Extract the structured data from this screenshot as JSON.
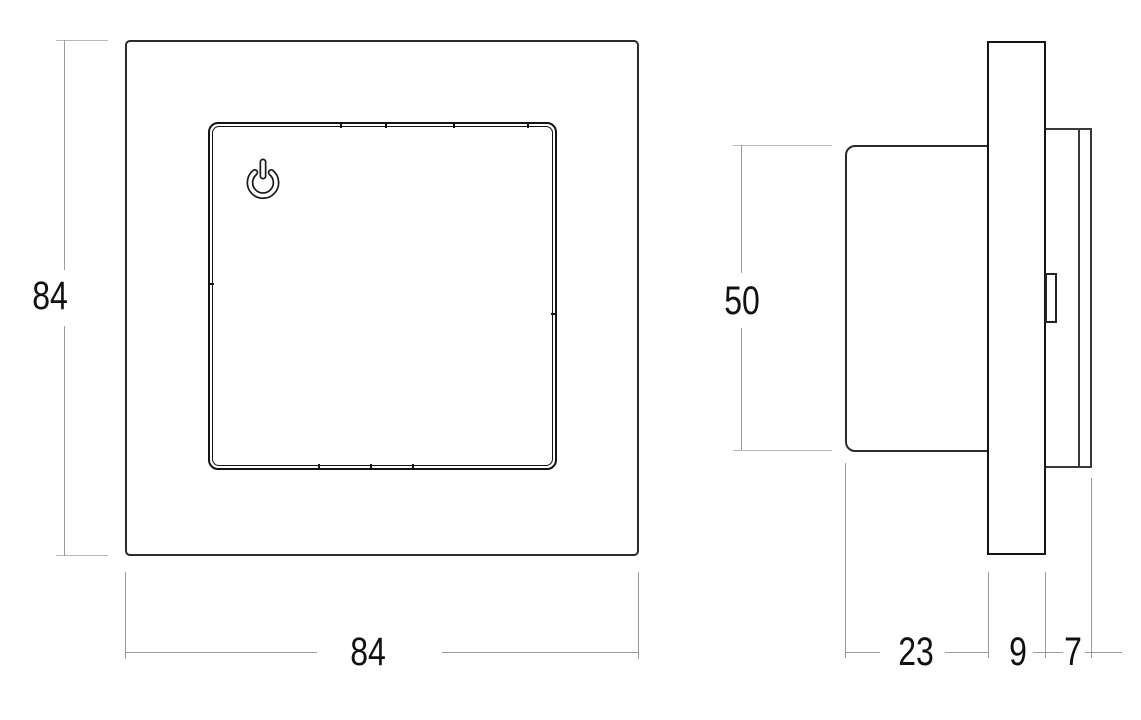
{
  "drawing_type": "dimension-drawing",
  "front_view": {
    "name": "front view",
    "size_label_vertical": "84",
    "size_label_horizontal": "84",
    "power_icon": "power-icon"
  },
  "side_view": {
    "name": "side view",
    "height_label": "50",
    "body_depth_label": "23",
    "plate_depth_label": "9",
    "rear_depth_label": "7"
  },
  "colors": {
    "background": "#ffffff",
    "part_outline": "#2b2b2b",
    "panel_outline": "#141414",
    "dimension_line": "#9b9b9b",
    "dimension_tick": "#b8b8b8",
    "text": "#111111"
  }
}
